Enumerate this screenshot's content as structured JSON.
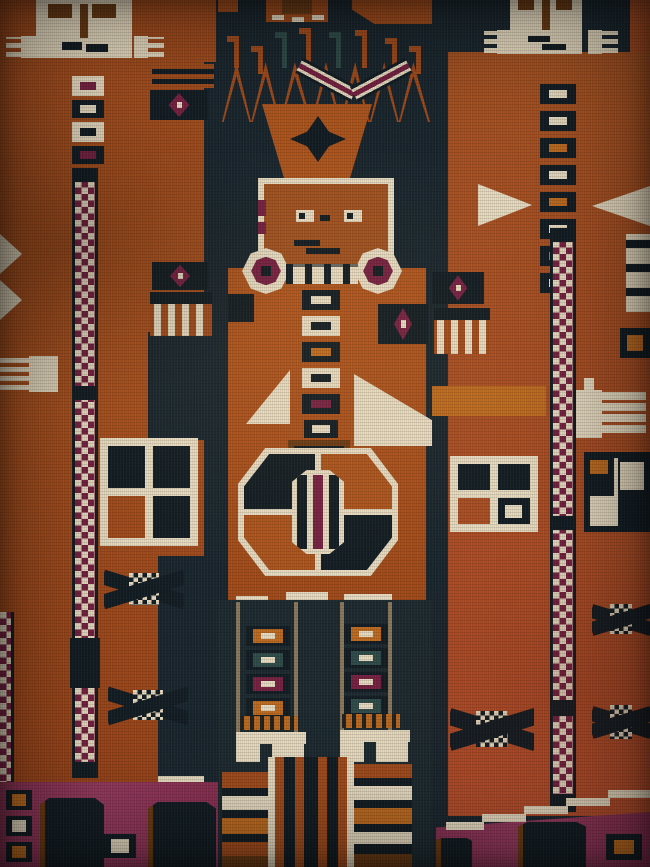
{
  "meta": {
    "type": "photograph",
    "subject": "Close-up of a hand-knotted pictorial tribal rug depicting three stylized human figures",
    "tradition": "Central Asian / Baluch pictorial pile weaving",
    "alt_text": "Woven rug detail: a central crowned figure with beaded necklace, octagonal gul medallion body and striped legs, flanked by two white-faced column figures with checkerboard staffs, four-pane window motifs, star motifs, combs, fringes and amulets, in rust orange, dark indigo, cream and aubergine wool"
  },
  "palette": {
    "field_navy": "#1a272f",
    "navy_deep": "#131e25",
    "rust": "#a54c1b",
    "rust_bright": "#b0551c",
    "rust_red": "#ad4e22",
    "face_rust": "#a4521f",
    "cream": "#e8dcc1",
    "cream_dim": "#d9cba8",
    "aubergine": "#7a2143",
    "magenta": "#8f3356",
    "brown": "#6e3c14",
    "grey_tan": "#8d7a5c",
    "orange_accent": "#c06b1e",
    "spike_teal": "#2f4d4b"
  },
  "figures": {
    "left": {
      "label": "Left flanking figure: white face, ornament buttons, checkerboard staff, window, stars, amulets and fringe"
    },
    "center": {
      "label": "Central crowned figure: zigzag crown, chevron arc, orange face, beaded necklace, button column, white wings, octagonal medallion and striped legs"
    },
    "right": {
      "label": "Right flanking figure: white face, long button column, checkerboard staff, two windows, stars, combs and fringe"
    }
  },
  "motifs": {
    "checker_band": "checkerboard staff band",
    "window": "four-pane window motif",
    "star": "eight-point star motif",
    "jewel": "amulet with aubergine diamond",
    "fringe": "knotted fringe tassels",
    "comb": "comb / hand motif",
    "medallion": "octagonal gul medallion",
    "necklace": "beaded necklace with rosette ends",
    "crown": "zigzag crown with spikes",
    "rosette": "stepped rosette",
    "feet": "stepped feet",
    "stripes": "striped kilim leg panel",
    "tree": "dark shrub silhouette on aubergine ground"
  }
}
